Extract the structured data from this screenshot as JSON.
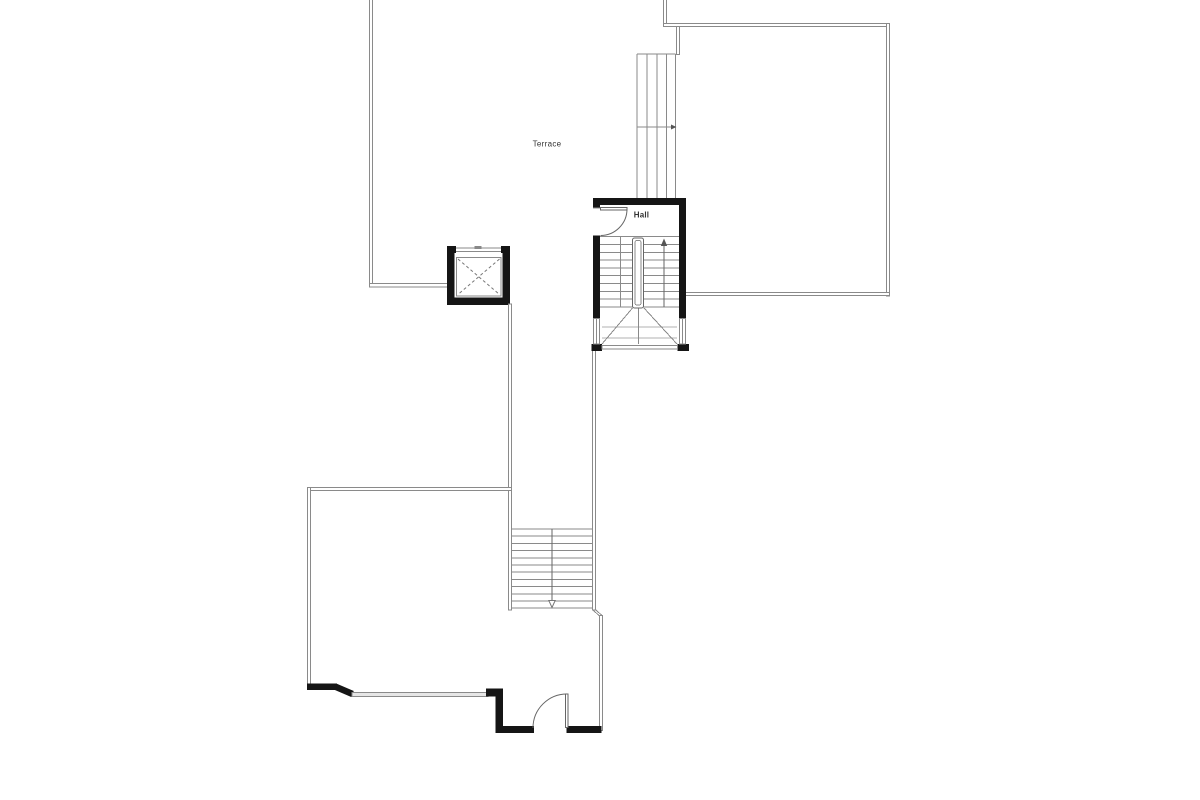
{
  "drawing": {
    "type": "architectural floor plan, upper level",
    "rooms": [
      {
        "id": "terrace",
        "label": "Terrace"
      },
      {
        "id": "hall",
        "label": "Hall"
      }
    ],
    "features": [
      "terrace walls (thin double line)",
      "elevator shaft with dashed X cabin",
      "hall stairwell with U-stair, center rail, winder treads, two windows, swing door",
      "exterior stair strip with direction mark",
      "upper-right room outline",
      "lower-left room with angled corner and glazed wall",
      "lower straight stair with down arrow",
      "lower room with bottom entry door"
    ]
  },
  "colors": {
    "background": "#ffffff",
    "wall_thick": "#151515",
    "line": "#8a8a8a",
    "line_light": "#b0b0b0",
    "line_dark": "#666666",
    "text": "#333333",
    "window_fill": "#e6e6e6"
  }
}
